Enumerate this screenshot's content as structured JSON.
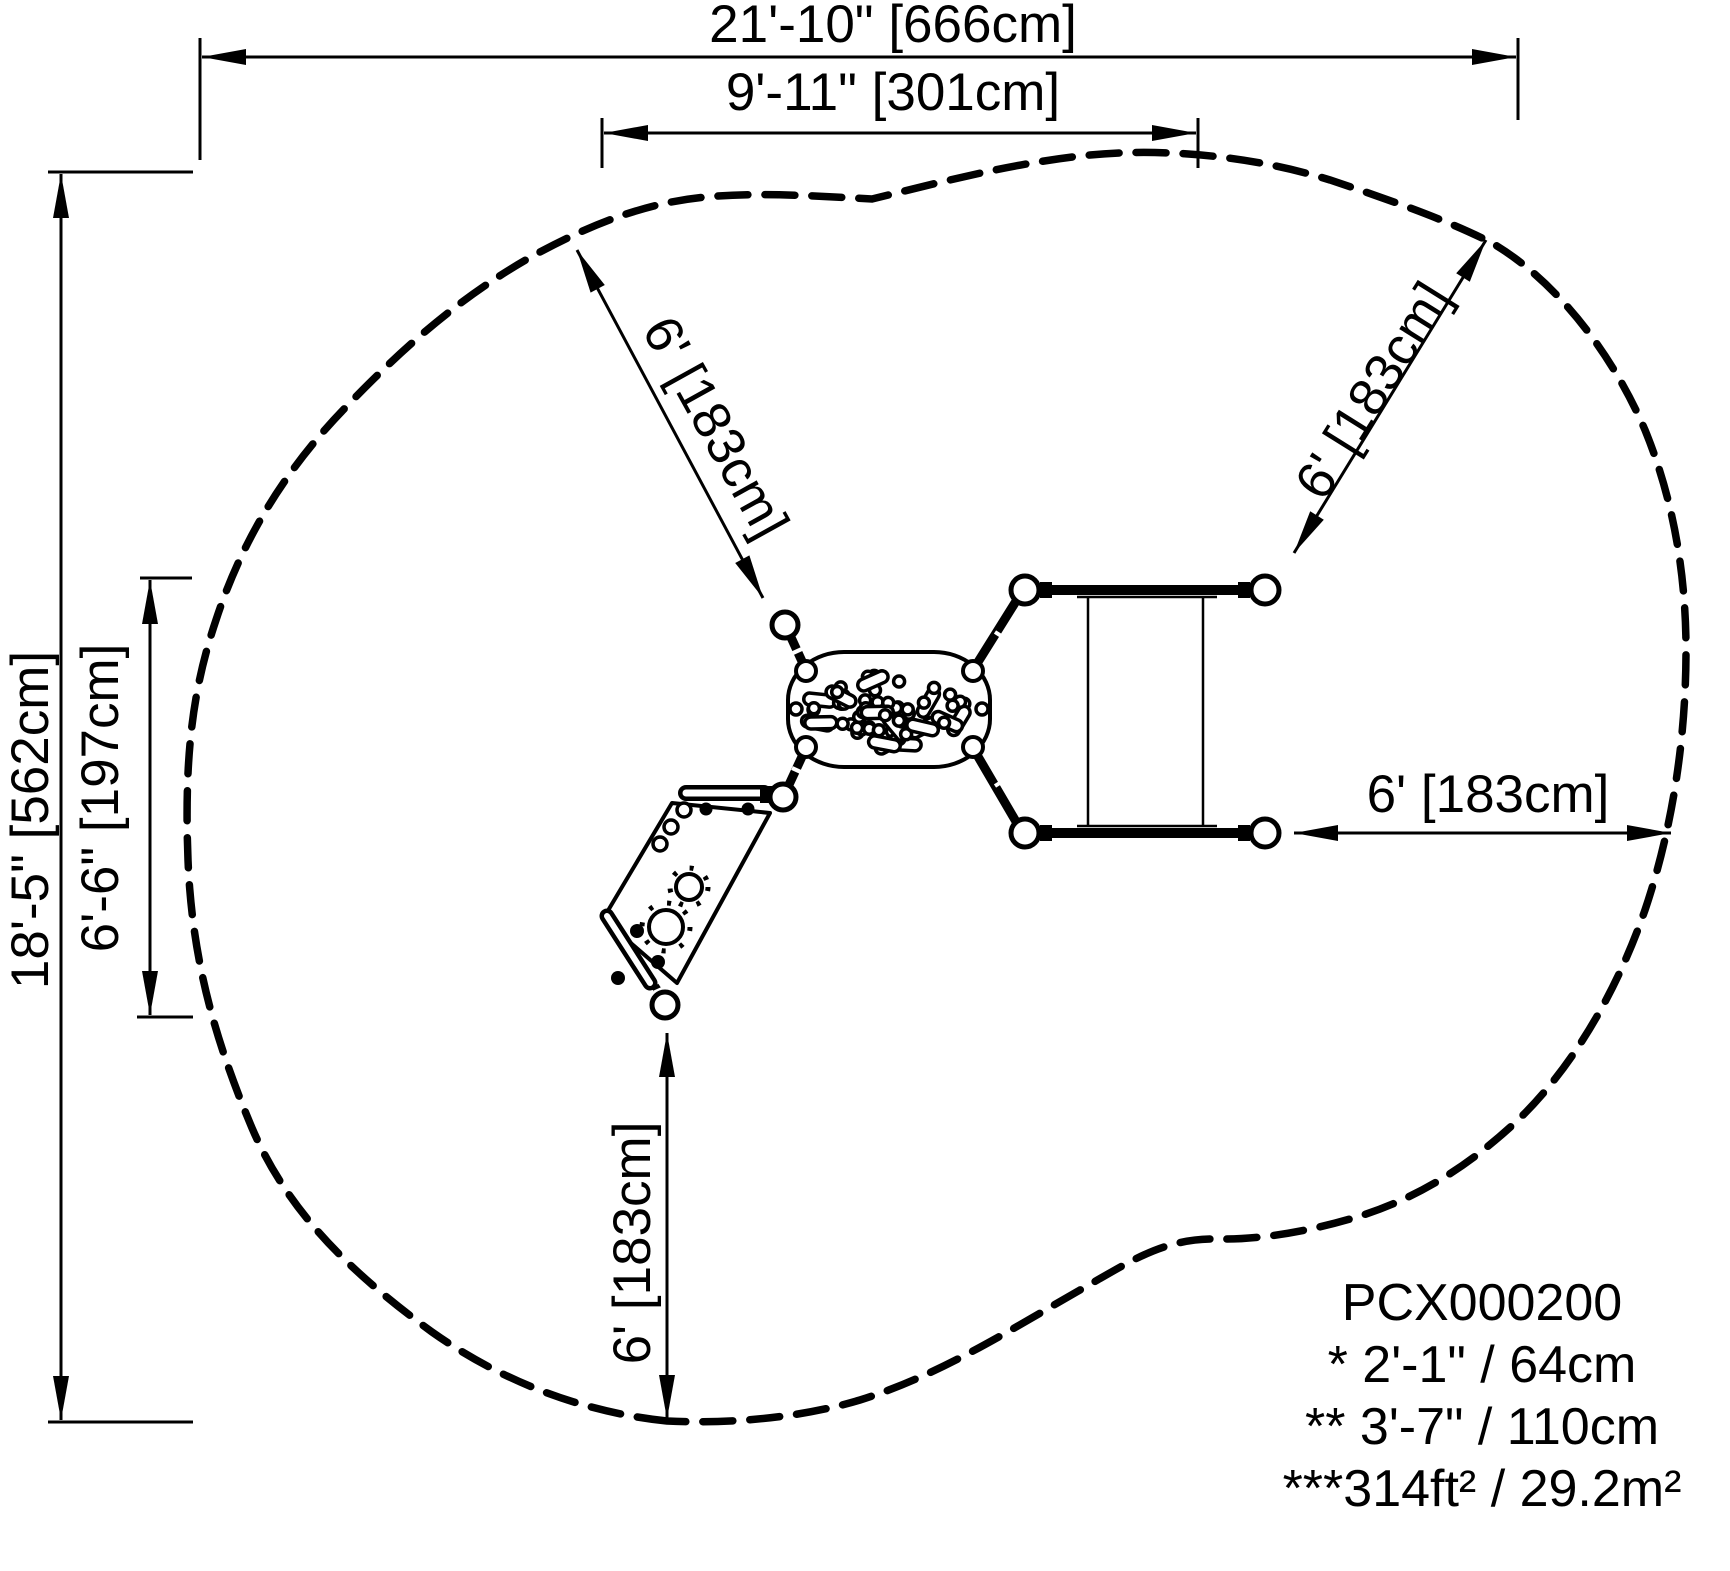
{
  "drawing": {
    "dim_overall_width": "21'-10\" [666cm]",
    "dim_inner_width": "9'-11\" [301cm]",
    "dim_overall_depth": "18'-5\" [562cm]",
    "dim_inner_depth": "6'-6\" [197cm]",
    "dim_use_zone_nw": "6' [183cm]",
    "dim_use_zone_ne": "6' [183cm]",
    "dim_use_zone_east": "6' [183cm]",
    "dim_use_zone_south": "6' [183cm]",
    "info": {
      "model": "PCX000200",
      "note_fall_height": "* 2'-1\" / 64cm",
      "note_highest_point": "** 3'-7\" / 110cm",
      "note_use_zone_area": "***314ft² / 29.2m²"
    },
    "colors": {
      "ink": "#000000",
      "paper": "#ffffff"
    }
  }
}
